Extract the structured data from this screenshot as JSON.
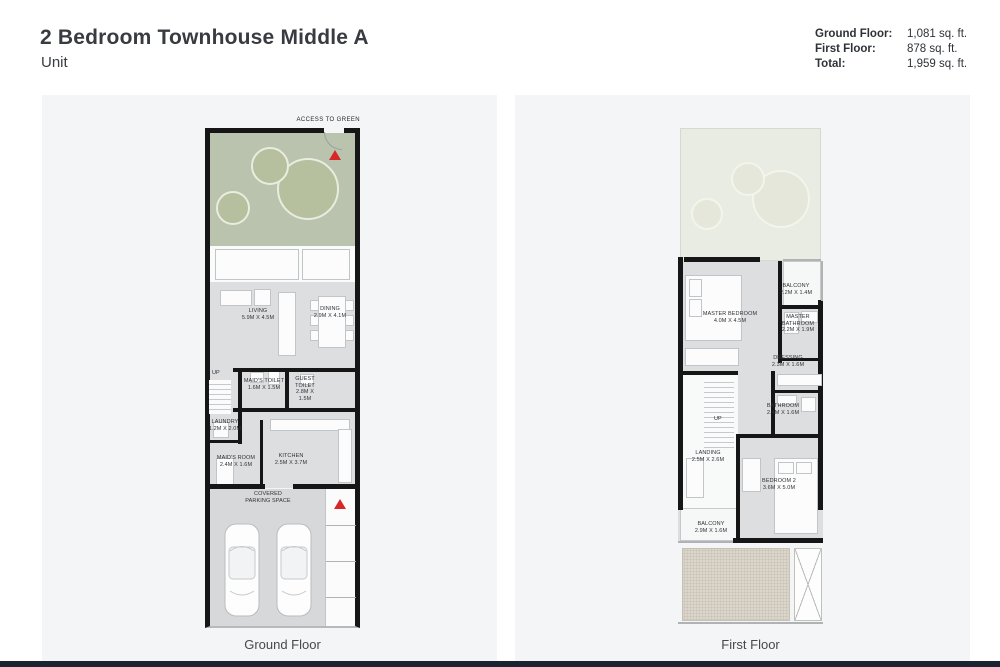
{
  "header": {
    "title": "2 Bedroom Townhouse Middle A",
    "subtitle": "Unit",
    "area_summary": [
      {
        "label": "Ground Floor:",
        "value": "1,081 sq. ft."
      },
      {
        "label": "First Floor:",
        "value": "878 sq. ft."
      },
      {
        "label": "Total:",
        "value": "1,959 sq. ft."
      }
    ]
  },
  "ground_floor": {
    "caption": "Ground Floor",
    "access_label": "ACCESS TO GREEN",
    "up_label": "UP",
    "rooms": {
      "living": {
        "name": "LIVING",
        "dim": "5.9M X 4.5M"
      },
      "dining": {
        "name": "DINING",
        "dim": "2.9M X 4.1M"
      },
      "maids_toilet": {
        "name": "MAID'S TOILET",
        "dim": "1.6M X 1.5M"
      },
      "guest_toilet": {
        "name": "GUEST TOILET",
        "dim": "2.8M X 1.5M"
      },
      "laundry": {
        "name": "LAUNDRY",
        "dim": "1.2M X 2.0M"
      },
      "maids_room": {
        "name": "MAID'S ROOM",
        "dim": "2.4M X 1.6M"
      },
      "kitchen": {
        "name": "KITCHEN",
        "dim": "2.5M X 3.7M"
      },
      "parking": {
        "name": "COVERED PARKING SPACE"
      }
    }
  },
  "first_floor": {
    "caption": "First Floor",
    "up_label": "UP",
    "rooms": {
      "balcony_top": {
        "name": "BALCONY",
        "dim": "2.2M X 1.4M"
      },
      "master_bedroom": {
        "name": "MASTER BEDROOM",
        "dim": "4.0M X 4.5M"
      },
      "master_bathroom": {
        "name": "MASTER BATHROOM",
        "dim": "2.2M X 1.9M"
      },
      "dressing": {
        "name": "DRESSING",
        "dim": "2.3M X 1.6M"
      },
      "bathroom": {
        "name": "BATHROOM",
        "dim": "2.4M X 1.6M"
      },
      "landing": {
        "name": "LANDING",
        "dim": "2.5M X 2.6M"
      },
      "bedroom2": {
        "name": "BEDROOM 2",
        "dim": "3.6M X 5.0M"
      },
      "balcony_bottom": {
        "name": "BALCONY",
        "dim": "2.9M X 1.6M"
      }
    }
  },
  "colors": {
    "accent_red": "#d62828",
    "wall_black": "#161616",
    "floor_gray": "#dcdee0",
    "garden_green": "#bac3ad",
    "panel_bg": "#f4f5f6",
    "bottom_bar": "#1b2531"
  }
}
